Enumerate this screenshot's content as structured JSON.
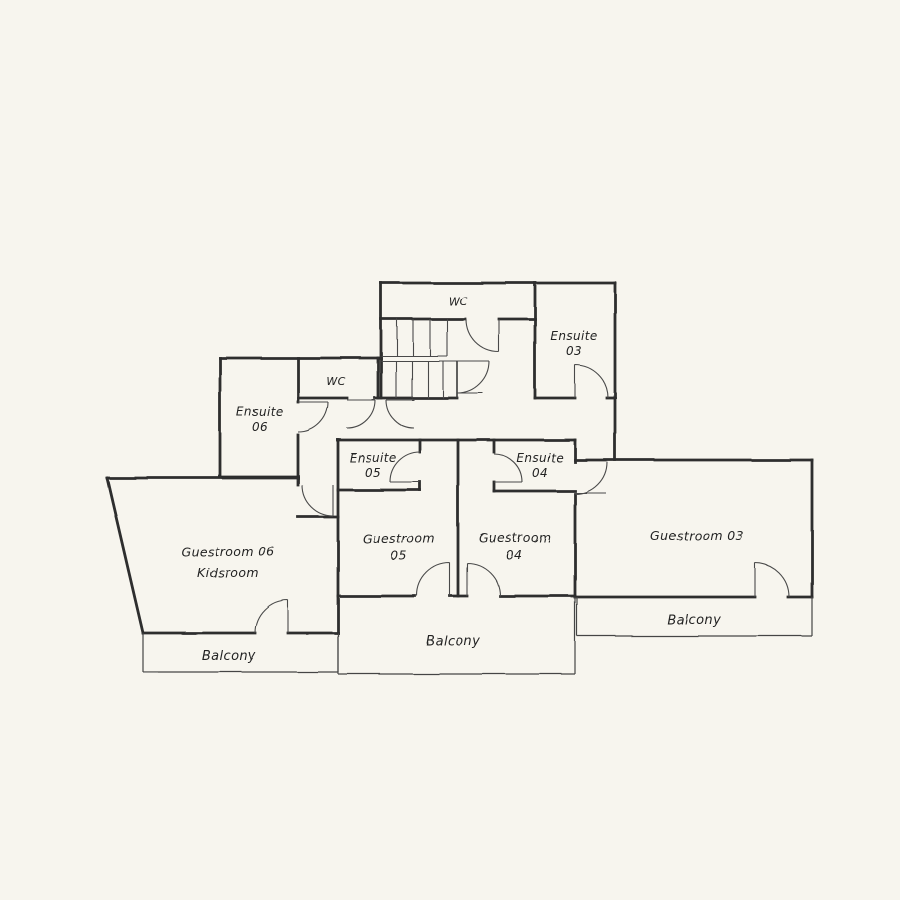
{
  "canvas": {
    "background_color": "#f7f5ee",
    "wall_ink_color": "#2d2d2d",
    "thin_ink_color": "#454545",
    "style": "hand-drawn architectural floor plan sketch"
  },
  "floorplan": {
    "rooms": {
      "wc_top": {
        "label": "WC"
      },
      "wc_mid": {
        "label": "WC"
      },
      "ensuite_03": {
        "name": "Ensuite",
        "number": "03"
      },
      "ensuite_06": {
        "name": "Ensuite",
        "number": "06"
      },
      "ensuite_05": {
        "name": "Ensuite",
        "number": "05"
      },
      "ensuite_04": {
        "name": "Ensuite",
        "number": "04"
      },
      "guestroom_06": {
        "line1": "Guestroom 06",
        "line2": "Kidsroom"
      },
      "guestroom_05": {
        "name": "Guestroom",
        "number": "05"
      },
      "guestroom_04": {
        "name": "Guestroom",
        "number": "04"
      },
      "guestroom_03": {
        "label": "Guestroom 03"
      },
      "balcony_left": {
        "label": "Balcony"
      },
      "balcony_middle": {
        "label": "Balcony"
      },
      "balcony_right": {
        "label": "Balcony"
      }
    }
  }
}
